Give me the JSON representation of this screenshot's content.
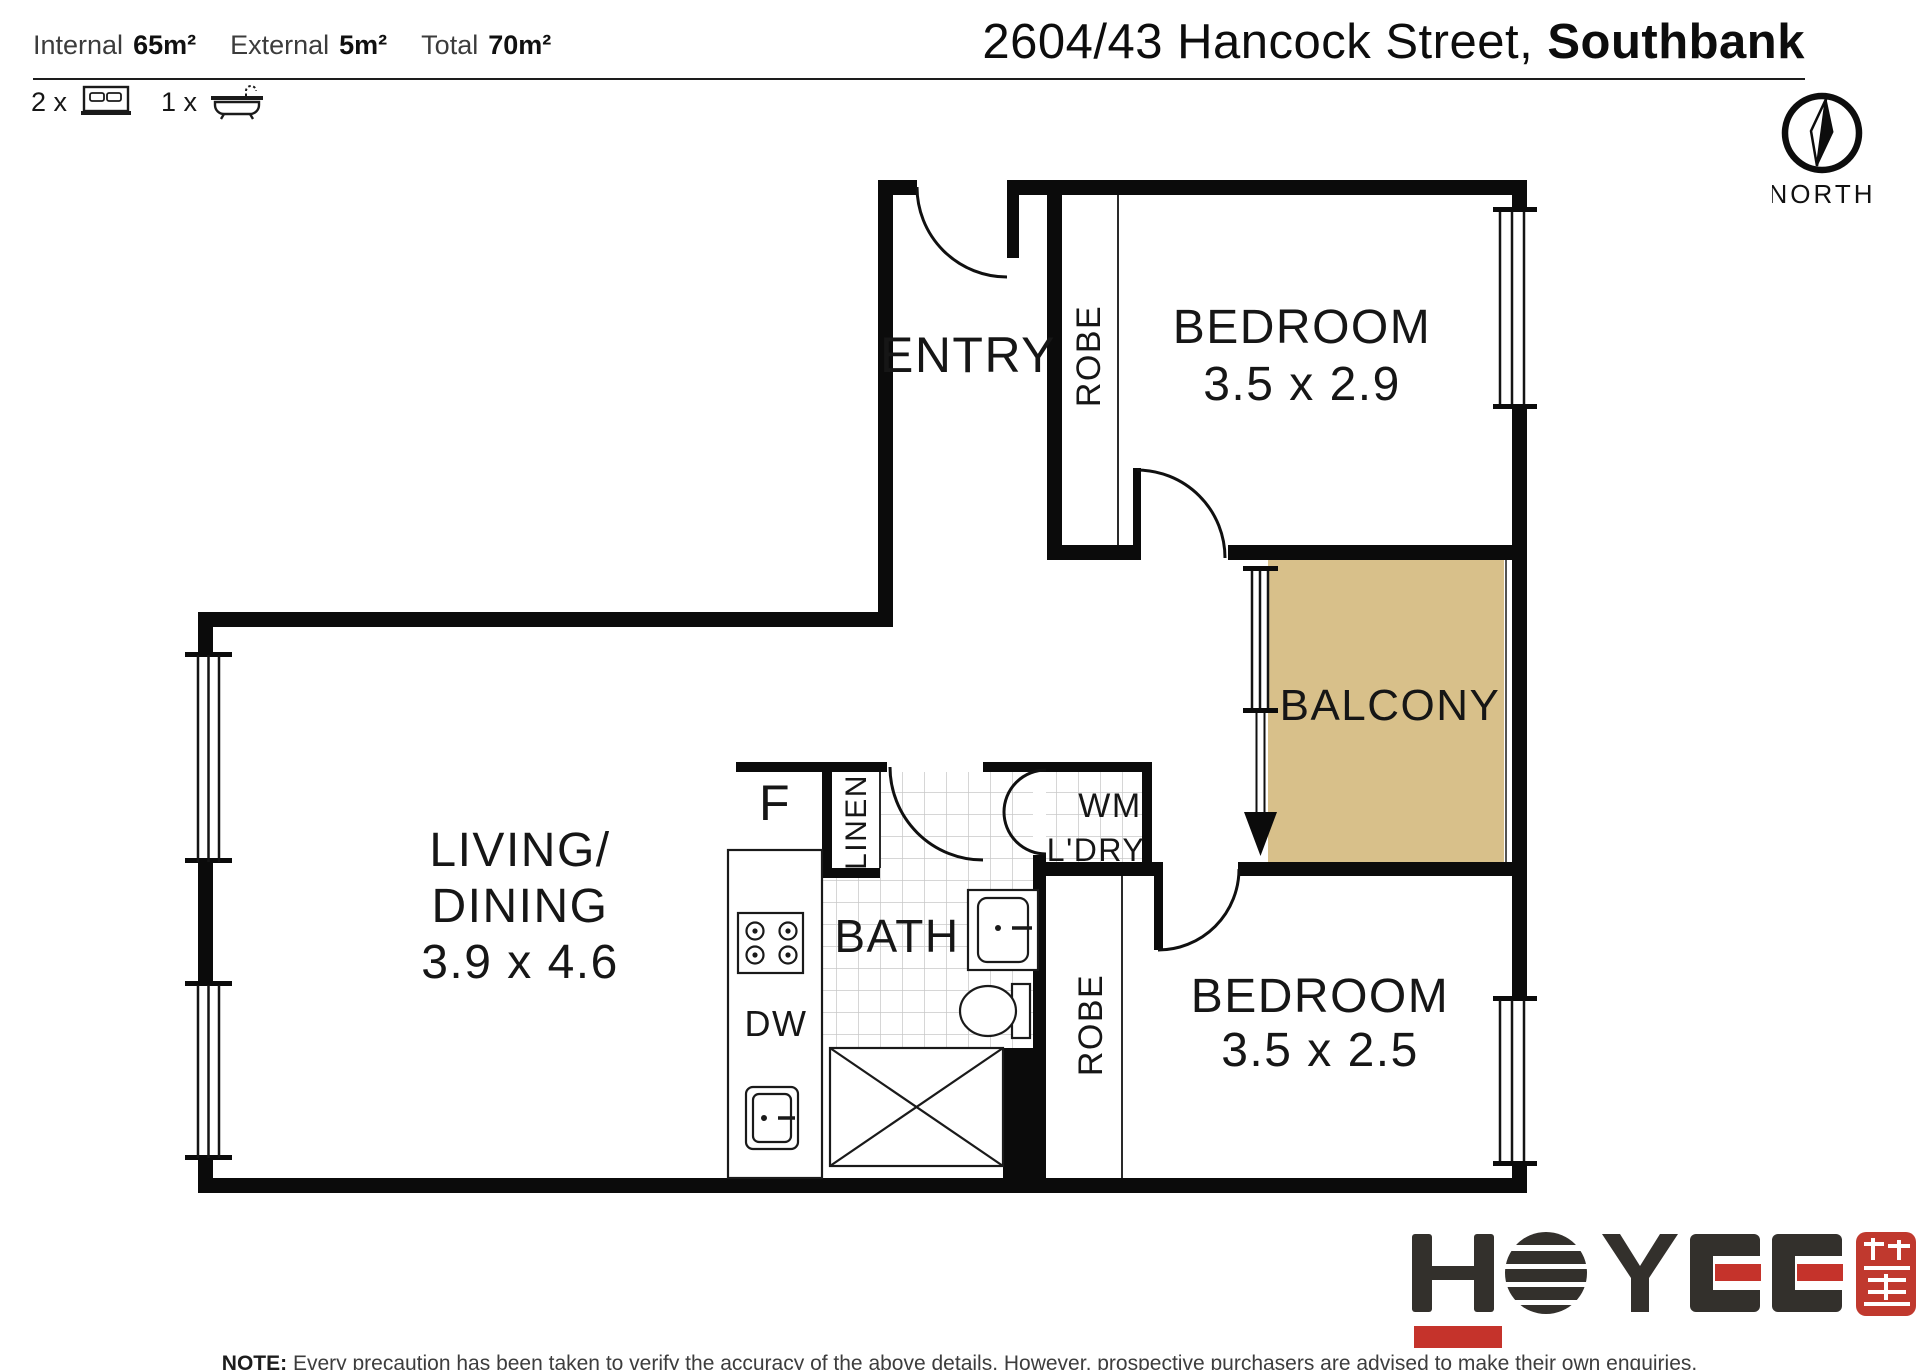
{
  "header": {
    "stats": [
      {
        "label": "Internal",
        "value": "65m²"
      },
      {
        "label": "External",
        "value": "5m²"
      },
      {
        "label": "Total",
        "value": "70m²"
      }
    ],
    "bed_count": "2 x",
    "bath_count": "1 x",
    "title_regular": "2604/43 Hancock Street,",
    "title_bold": "Southbank",
    "compass_label": "NORTH"
  },
  "plan": {
    "entry": "ENTRY",
    "robe_1": "ROBE",
    "bedroom_1_name": "BEDROOM",
    "bedroom_1_dims": "3.5 x 2.9",
    "balcony": "BALCONY",
    "living_line_1": "LIVING/",
    "living_line_2": "DINING",
    "living_dims": "3.9 x 4.6",
    "bath": "BATH",
    "linen": "LINEN",
    "wm": "WM",
    "ldry": "L'DRY",
    "fridge": "F",
    "dishwasher": "DW",
    "robe_2": "ROBE",
    "bedroom_2_name": "BEDROOM",
    "bedroom_2_dims": "3.5 x 2.5",
    "colors": {
      "balcony": "#d8c08a",
      "wall": "#0b0b0b",
      "tile": "#c8c8c8"
    }
  },
  "logo": {
    "name": "HOYEE"
  },
  "footer": {
    "note_label": "NOTE:",
    "note_text": "Every precaution has been taken to verify the accuracy of the above details. However, prospective purchasers are advised to make their own enquiries."
  }
}
